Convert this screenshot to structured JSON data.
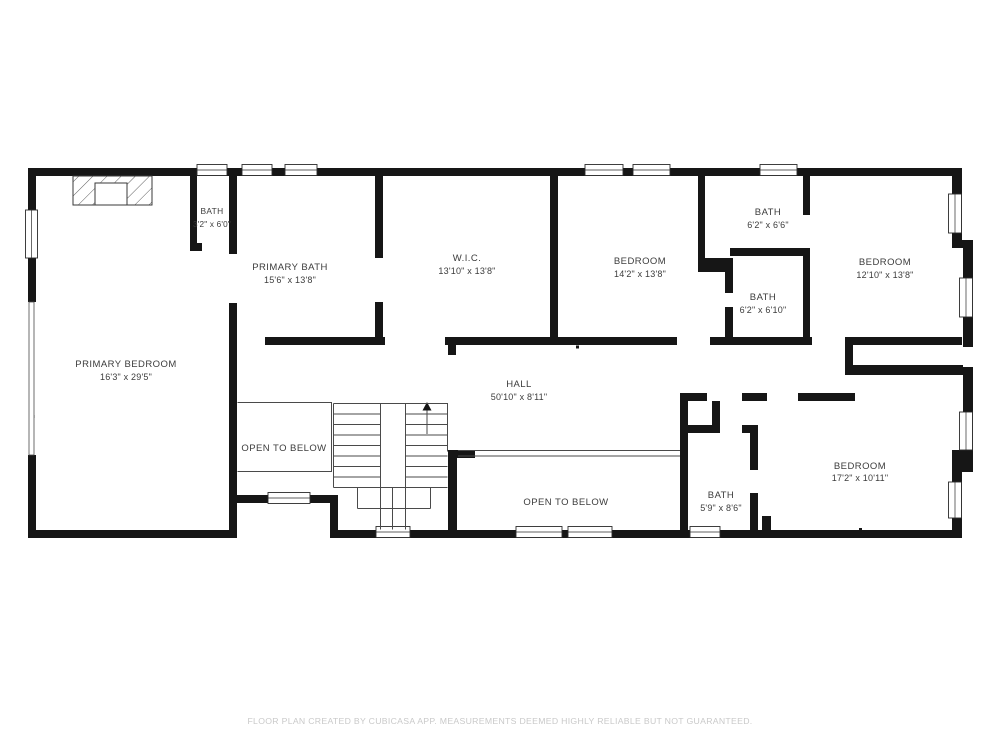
{
  "floor_plan": {
    "rooms": [
      {
        "name": "BATH",
        "dims": "3'2\" x 6'0\""
      },
      {
        "name": "PRIMARY BATH",
        "dims": "15'6\" x 13'8\""
      },
      {
        "name": "W.I.C.",
        "dims": "13'10\" x 13'8\""
      },
      {
        "name": "BEDROOM",
        "dims": "14'2\" x 13'8\""
      },
      {
        "name": "BATH",
        "dims": "6'2\" x 6'6\""
      },
      {
        "name": "BATH",
        "dims": "6'2\" x 6'10\""
      },
      {
        "name": "BEDROOM",
        "dims": "12'10\" x 13'8\""
      },
      {
        "name": "PRIMARY BEDROOM",
        "dims": "16'3\" x 29'5\""
      },
      {
        "name": "HALL",
        "dims": "50'10\" x 8'11\""
      },
      {
        "name": "OPEN TO BELOW",
        "dims": ""
      },
      {
        "name": "OPEN TO BELOW",
        "dims": ""
      },
      {
        "name": "BATH",
        "dims": "5'9\" x 8'6\""
      },
      {
        "name": "BEDROOM",
        "dims": "17'2\" x 10'11\""
      }
    ],
    "footer": "FLOOR PLAN CREATED BY CUBICASA APP. MEASUREMENTS DEEMED HIGHLY RELIABLE BUT NOT GUARANTEED.",
    "colors": {
      "wall": "#161616",
      "label": "#3c3c3c",
      "thin": "#4a4a4a",
      "footer": "#c9c9c9"
    }
  }
}
